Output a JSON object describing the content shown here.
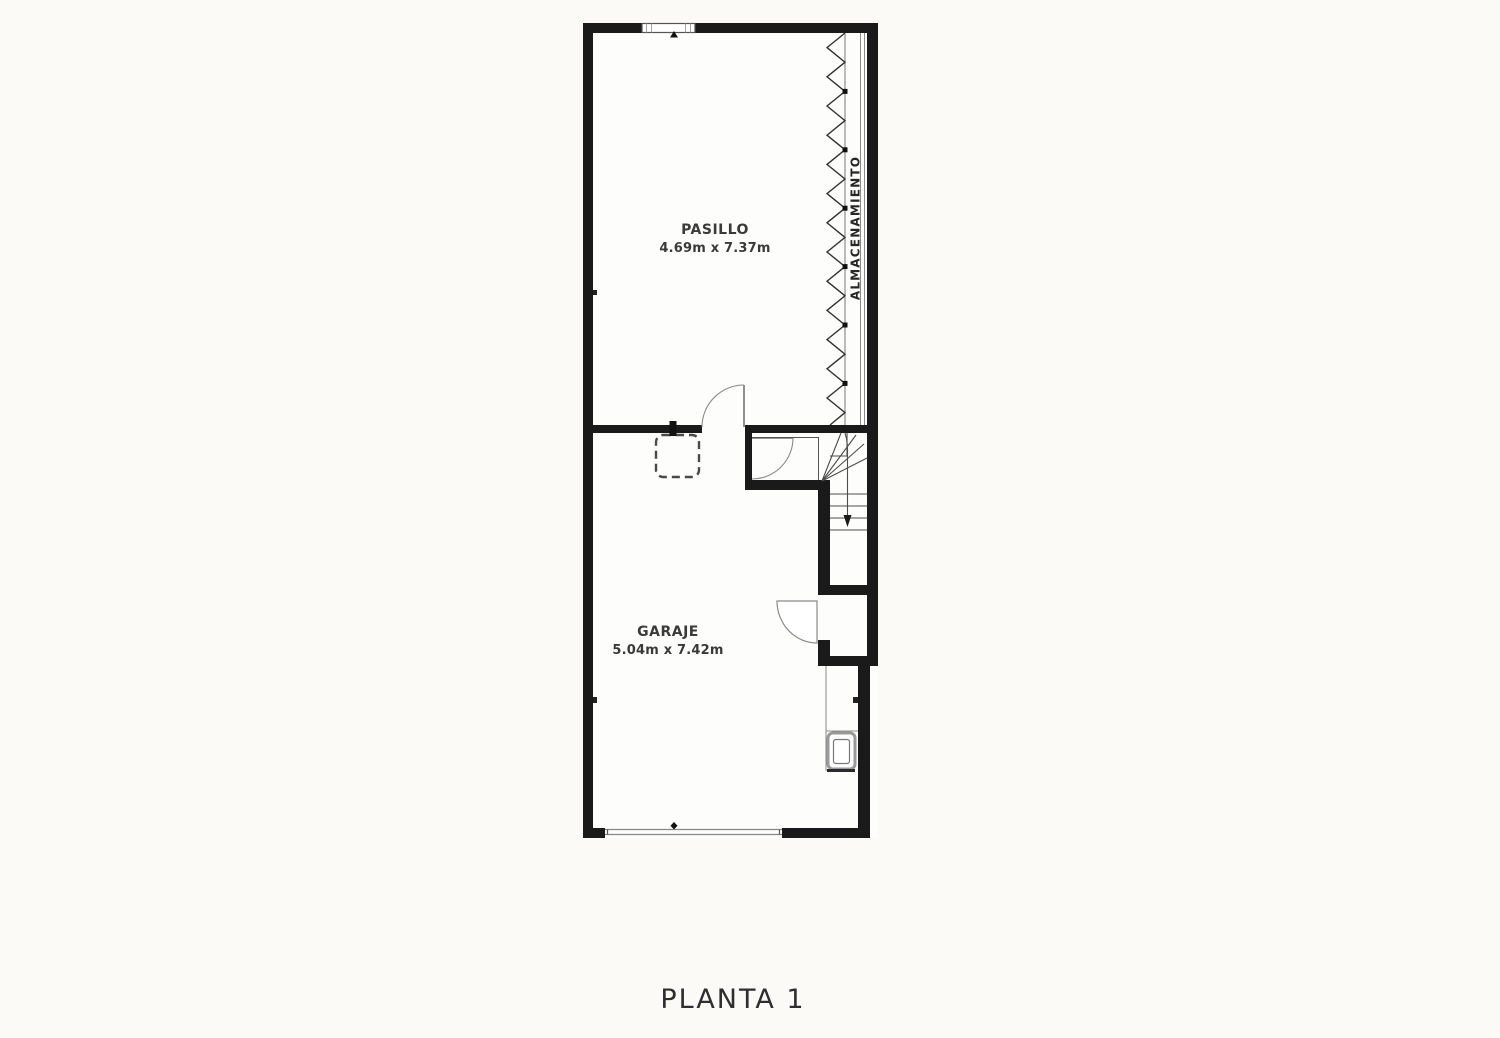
{
  "plan": {
    "title": "PLANTA 1",
    "rooms": [
      {
        "name": "PASILLO",
        "dimensions": "4.69m x 7.37m"
      },
      {
        "name": "GARAJE",
        "dimensions": "5.04m x 7.42m"
      }
    ],
    "storage_label": "ALMACENAMIENTO"
  },
  "colors": {
    "wall": "#1a1a1a",
    "thin_line": "#555555",
    "door_arc": "#8a8a8a",
    "stair_line": "#4d4d4d",
    "label_text": "#3a3a3a",
    "storage_text": "#262626",
    "title_text": "#2e2e2e",
    "background": "#fbfaf7",
    "floor": "#fdfdfb"
  }
}
